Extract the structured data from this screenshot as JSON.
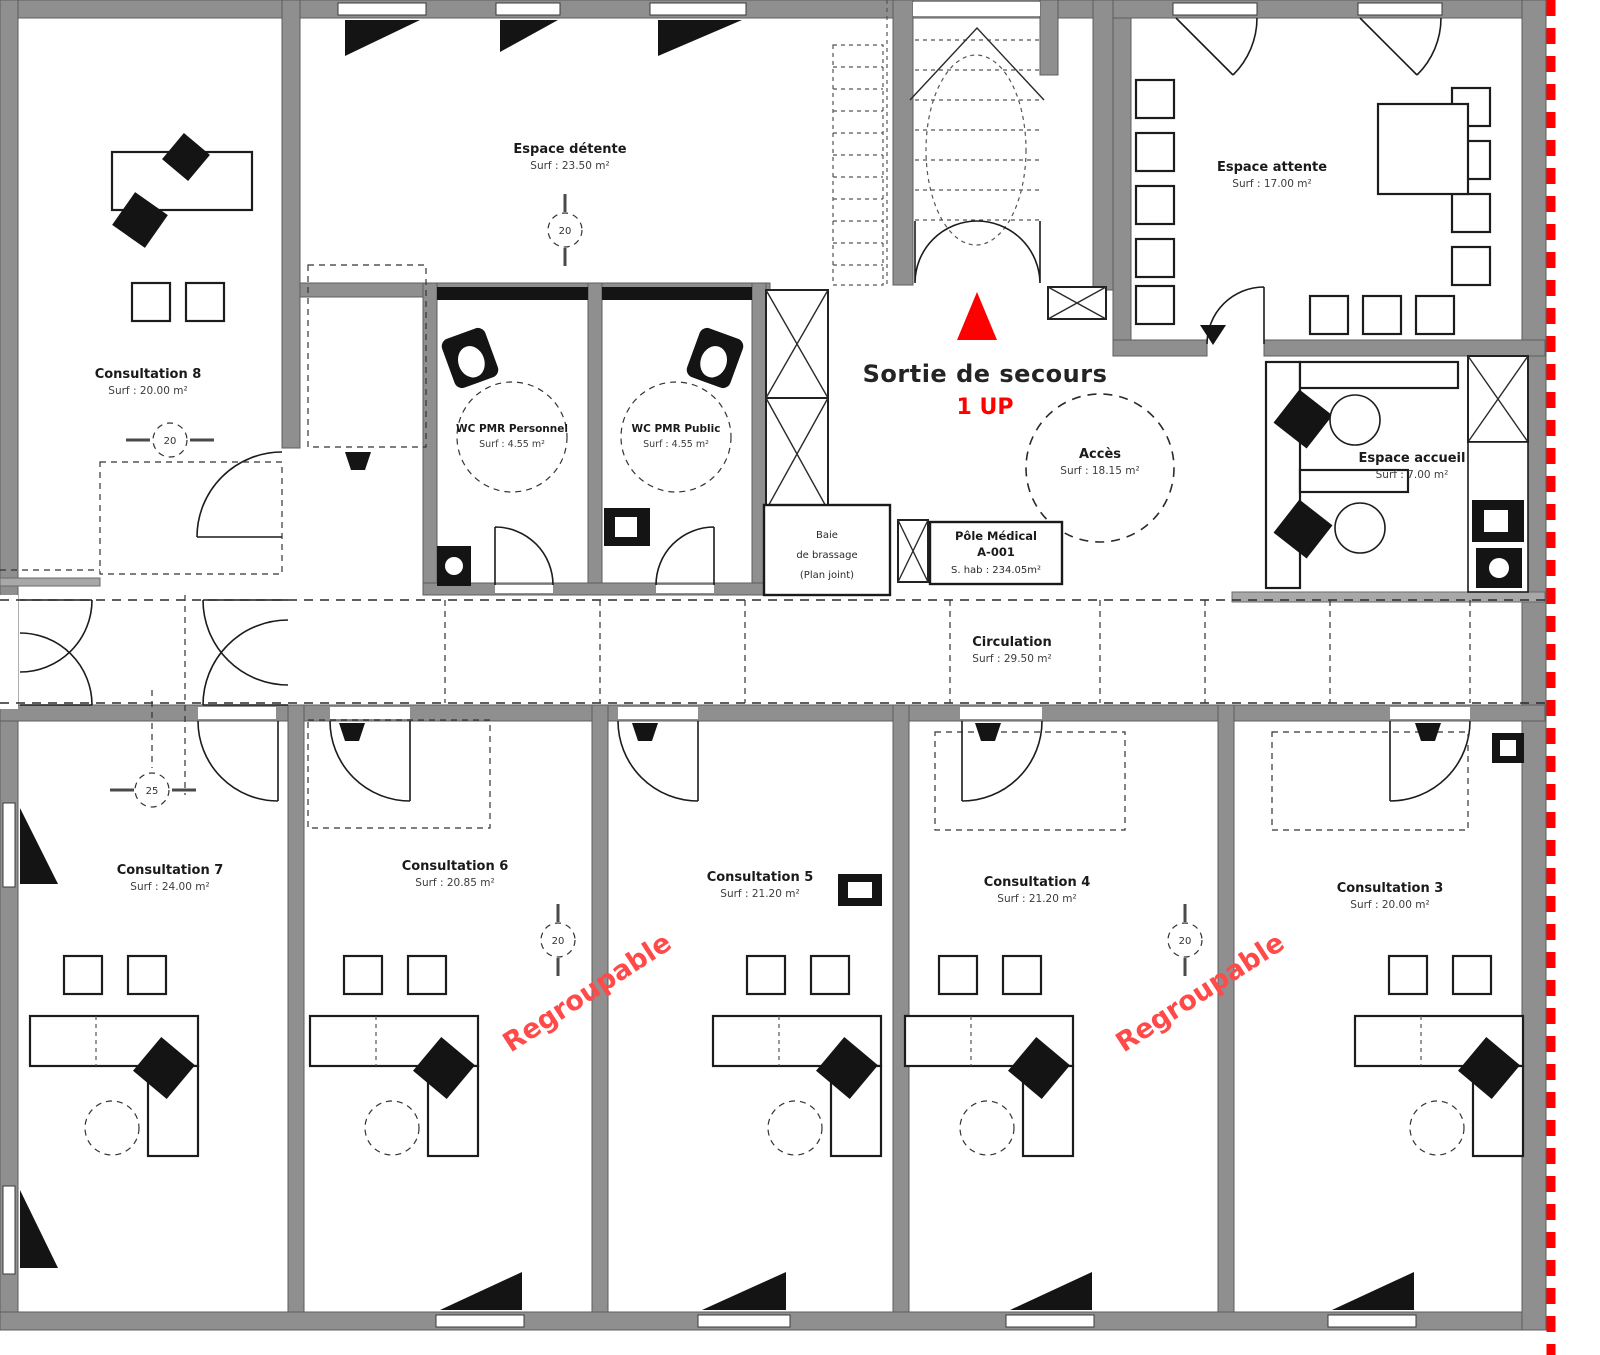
{
  "colors": {
    "accent_red": "#ff0000",
    "regroupable_red": "#ff4a4a",
    "wall_gray": "#8f8f8f"
  },
  "rooms": {
    "consultation8": {
      "name": "Consultation 8",
      "area": "Surf : 20.00 m²"
    },
    "espace_detente": {
      "name": "Espace détente",
      "area": "Surf : 23.50 m²"
    },
    "wc_pmr_personnel": {
      "name": "WC PMR Personnel",
      "area": "Surf : 4.55 m²"
    },
    "wc_pmr_public": {
      "name": "WC PMR Public",
      "area": "Surf : 4.55 m²"
    },
    "espace_attente": {
      "name": "Espace attente",
      "area": "Surf : 17.00 m²"
    },
    "espace_accueil": {
      "name": "Espace accueil",
      "area": "Surf : 7.00 m²"
    },
    "acces": {
      "name": "Accès",
      "area": "Surf : 18.15 m²"
    },
    "circulation": {
      "name": "Circulation",
      "area": "Surf : 29.50 m²"
    },
    "consultation7": {
      "name": "Consultation 7",
      "area": "Surf : 24.00 m²"
    },
    "consultation6": {
      "name": "Consultation 6",
      "area": "Surf : 20.85 m²"
    },
    "consultation5": {
      "name": "Consultation 5",
      "area": "Surf : 21.20 m²"
    },
    "consultation4": {
      "name": "Consultation 4",
      "area": "Surf : 21.20 m²"
    },
    "consultation3": {
      "name": "Consultation 3",
      "area": "Surf : 20.00 m²"
    }
  },
  "annotations": {
    "emergency_exit": "Sortie de secours",
    "emergency_exit_level": "1 UP",
    "regroupable": "Regroupable",
    "pole_medical": {
      "line1": "Pôle Médical",
      "line2": "A-001",
      "line3": "S. hab : 234.05m²"
    },
    "baie": {
      "line1": "Baie",
      "line2": "de brassage",
      "line3": "(Plan joint)"
    }
  },
  "markers": {
    "m1": "20",
    "m2": "20",
    "m3": "25",
    "m4": "20",
    "m5": "20"
  }
}
